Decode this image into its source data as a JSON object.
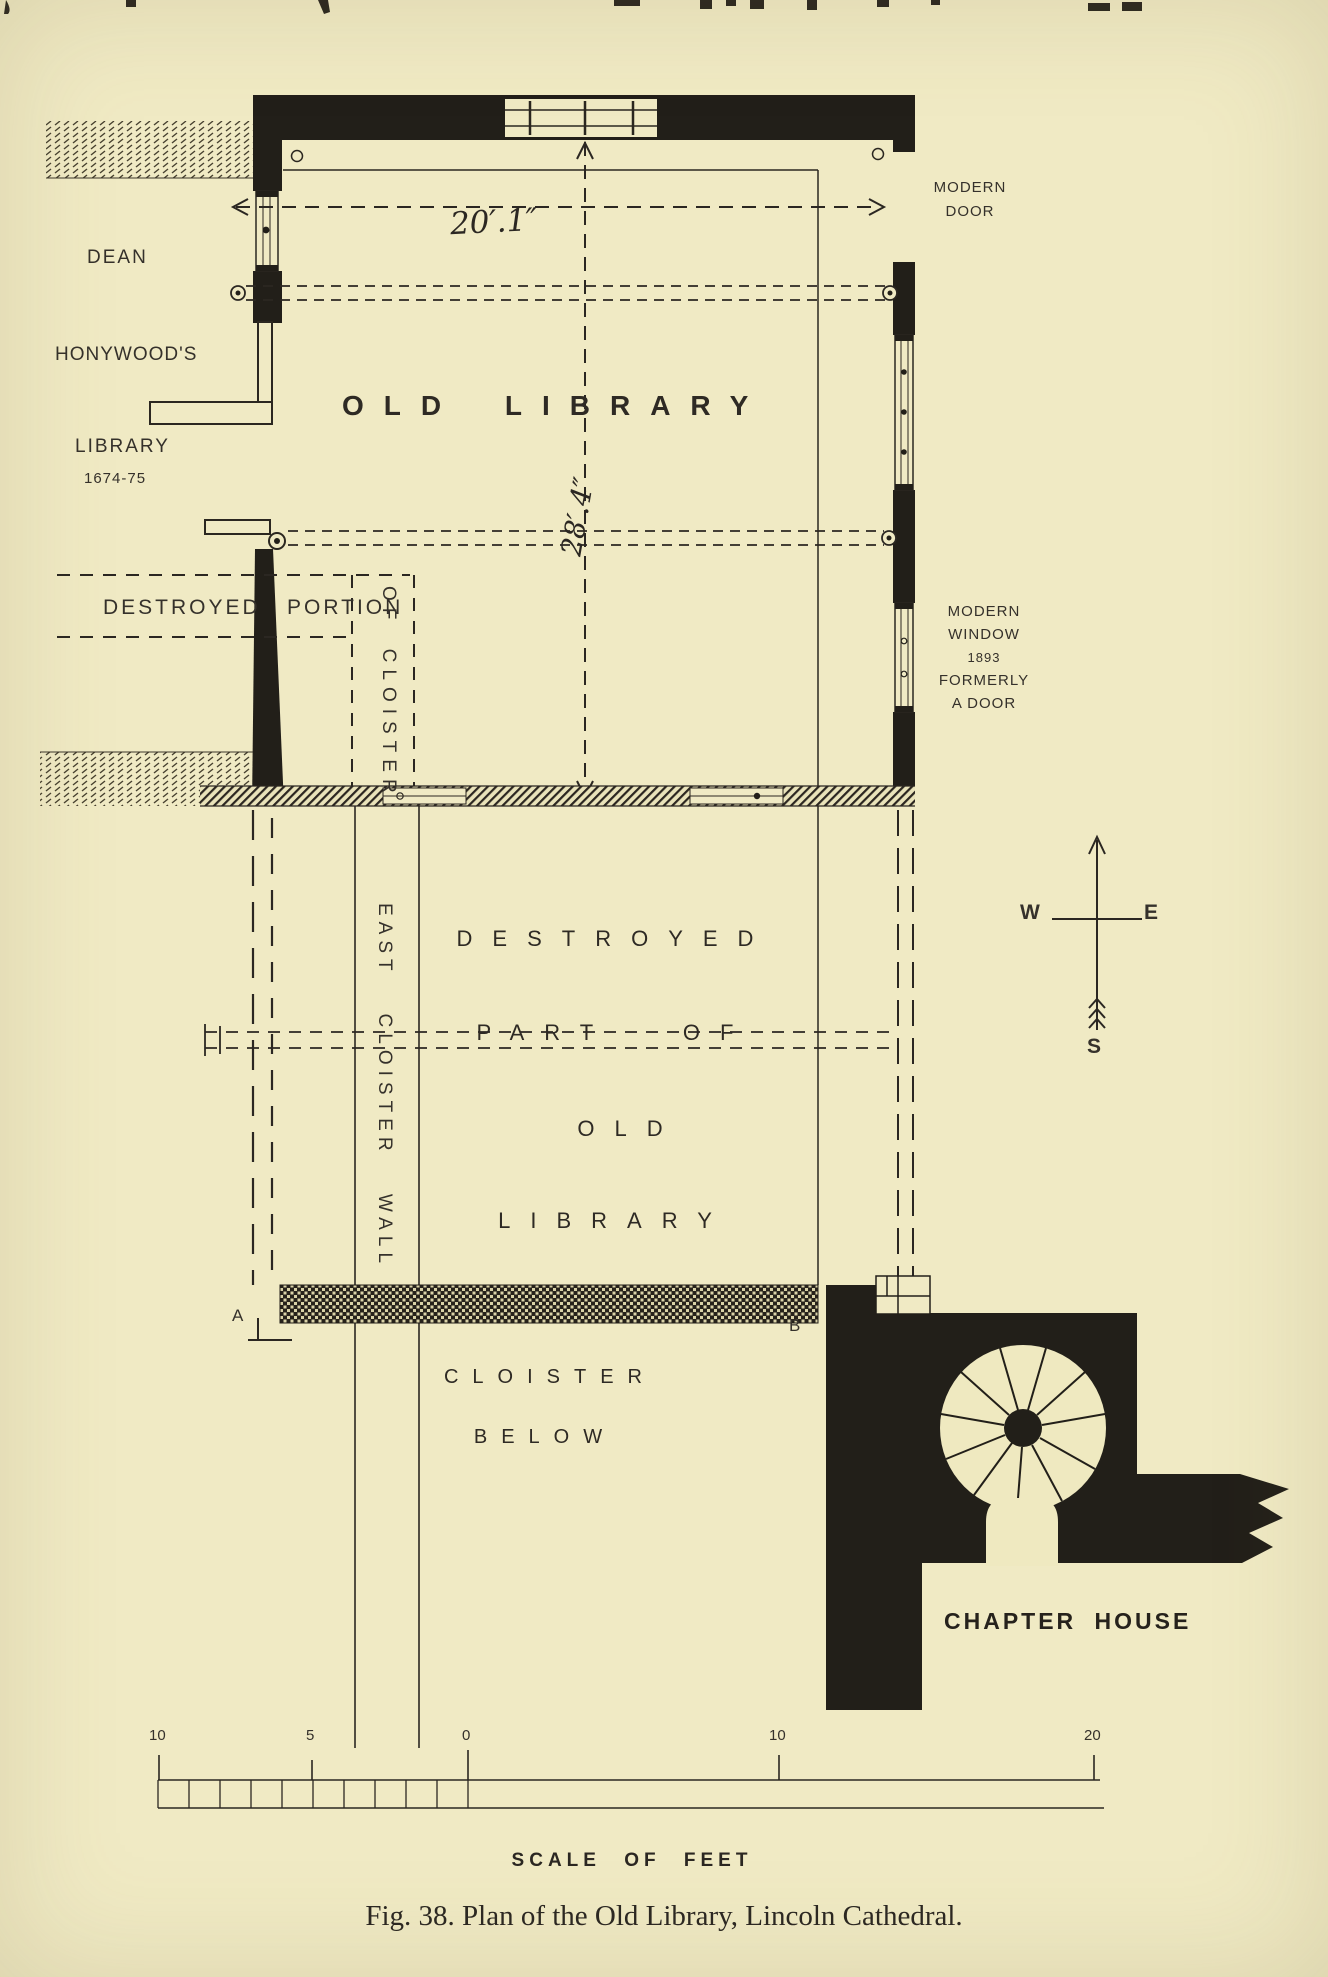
{
  "figure": {
    "caption": "Fig. 38.  Plan of the Old Library, Lincoln Cathedral.",
    "scale_label": "SCALE OF FEET"
  },
  "plan": {
    "rooms": {
      "old_library": "OLD LIBRARY",
      "dean_honywood": {
        "line1": "DEAN",
        "line2": "HONYWOOD'S",
        "line3": "LIBRARY",
        "years": "1674-75"
      },
      "destroyed_portion": {
        "word1": "DESTROYED",
        "word2": "PORTION"
      },
      "of_cloister": "OF CLOISTER",
      "east_cloister_wall": "EAST CLOISTER WALL",
      "destroyed_part": {
        "line1": "DESTROYED",
        "line2": "PART OF",
        "line3": "OLD",
        "line4": "LIBRARY"
      },
      "cloister_below": {
        "line1": "CLOISTER",
        "line2": "BELOW"
      },
      "chapter_house": "CHAPTER HOUSE"
    },
    "annotations": {
      "modern_door": {
        "line1": "MODERN",
        "line2": "DOOR"
      },
      "modern_window": {
        "line1": "MODERN",
        "line2": "WINDOW",
        "line3": "1893",
        "line4": "FORMERLY",
        "line5": "A DOOR"
      },
      "dim_width": "20′.1″",
      "dim_height": "28′.4″",
      "marker_a": "A",
      "marker_b": "B"
    },
    "compass": {
      "west": "W",
      "east": "E",
      "south": "S"
    },
    "scale_bar": {
      "labels": [
        "10",
        "5",
        "0",
        "10",
        "20"
      ]
    },
    "colors": {
      "paper": "#f0eac4",
      "ink": "#221f19",
      "text": "#35312b"
    }
  }
}
